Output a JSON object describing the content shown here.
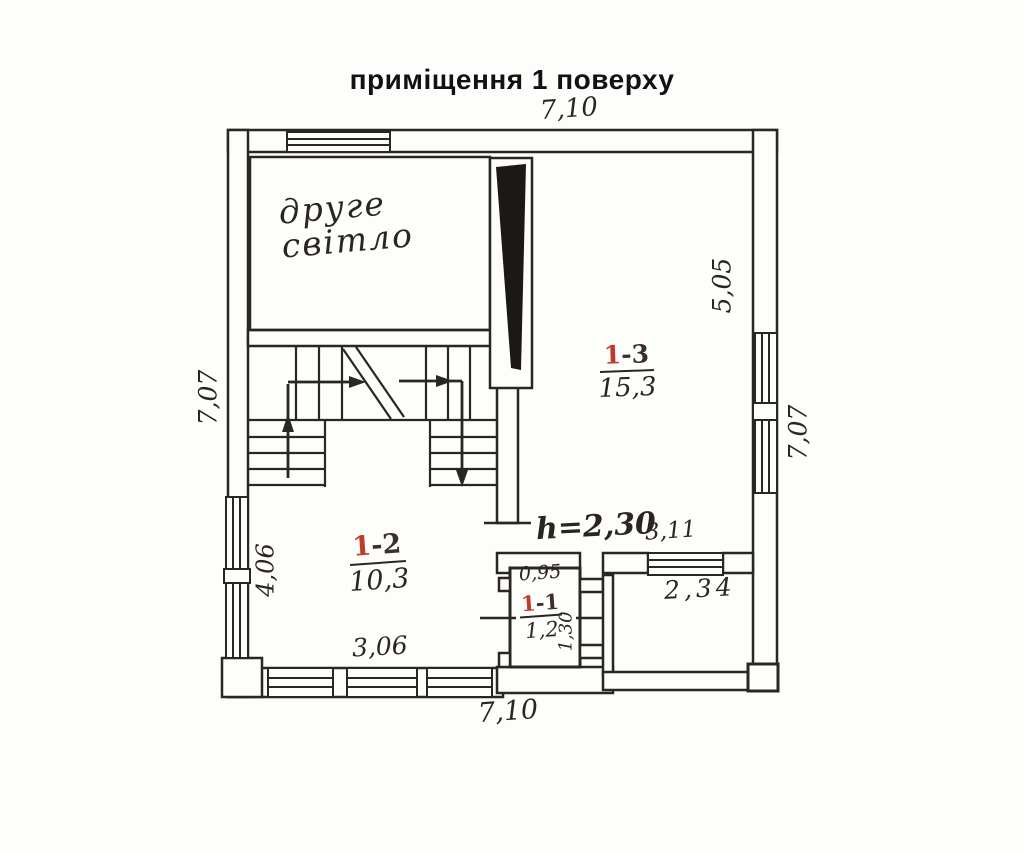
{
  "title": "приміщення 1 поверху",
  "plan": {
    "note_second_light": {
      "line1": "друге",
      "line2": "світло"
    },
    "height_note": "h=2,30",
    "rooms": {
      "r13": {
        "no_first": "1",
        "no_rest": "-3",
        "area": "15,3"
      },
      "r12": {
        "no_first": "1",
        "no_rest": "-2",
        "area": "10,3"
      },
      "r11": {
        "no_first": "1",
        "no_rest": "-1",
        "area": "1,2"
      }
    },
    "dims": {
      "top": "7,10",
      "bottom": "7,10",
      "left": "7,07",
      "right": "7,07",
      "d505": "5,05",
      "d406": "4,06",
      "d306": "3,06",
      "d311": "3,11",
      "d234": "2,34",
      "d095": "0,95",
      "d130": "1,30"
    },
    "colors": {
      "line": "#2a2622",
      "room_red": "#c03a2b",
      "background": "#fdfdfb"
    }
  }
}
